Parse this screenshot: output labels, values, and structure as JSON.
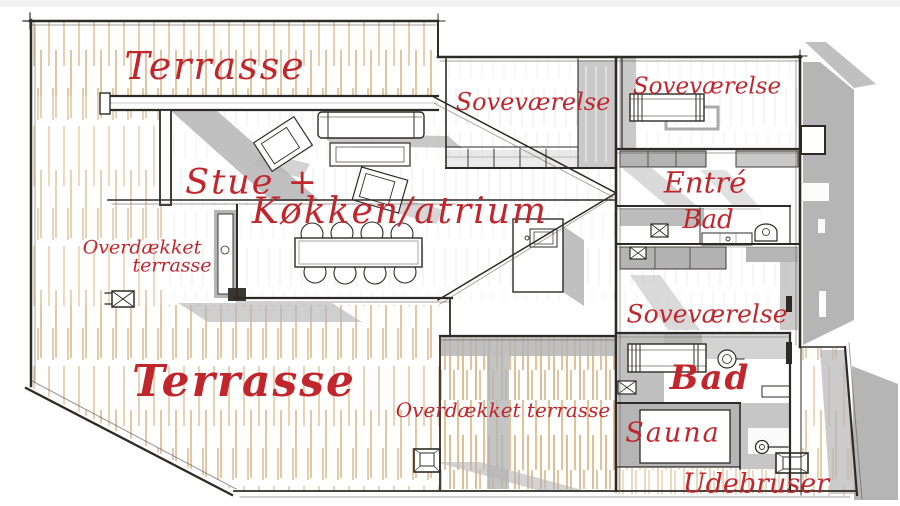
{
  "plan": {
    "type": "floor-plan-sketch",
    "colors": {
      "label_red": "#c1262d",
      "ink": "#2e2b26",
      "shadow_gray": "#b5b5b5",
      "plank_light": "#e2c194",
      "plank_dark": "#c78f49",
      "paper": "#ffffff"
    }
  },
  "labels": [
    {
      "id": "terrasse-top",
      "text": "Terrasse"
    },
    {
      "id": "sovevaerelse-top-middle",
      "text": "Soveværelse"
    },
    {
      "id": "sovevaerelse-top-right",
      "text": "Soveværelse"
    },
    {
      "id": "stue",
      "text": "Stue +"
    },
    {
      "id": "koekken-atrium",
      "text": "Køkken/atrium"
    },
    {
      "id": "overdaekket-left-line1",
      "text": "Overdækket"
    },
    {
      "id": "overdaekket-left-line2",
      "text": "terrasse"
    },
    {
      "id": "entre",
      "text": "Entré"
    },
    {
      "id": "bad-upper",
      "text": "Bad"
    },
    {
      "id": "sovevaerelse-middle-right",
      "text": "Soveværelse"
    },
    {
      "id": "terrasse-bottom",
      "text": "Terrasse"
    },
    {
      "id": "bad-lower",
      "text": "Bad"
    },
    {
      "id": "overdaekket-terrasse-bottom",
      "text": "Overdækket terrasse"
    },
    {
      "id": "sauna",
      "text": "Sauna"
    },
    {
      "id": "udebruser",
      "text": "Udebruser"
    }
  ]
}
